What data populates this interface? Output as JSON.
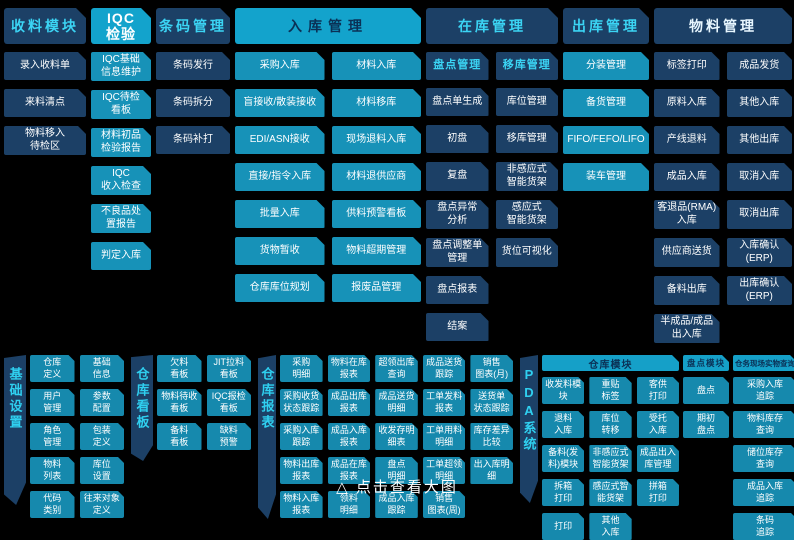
{
  "caption": "△ 点击查看大图",
  "colors": {
    "background": "#000000",
    "navy_block": "#1c4066",
    "teal_block": "#1792b8",
    "bottom_teal_block": "#1689ad",
    "header_cyan": "#13a3cc",
    "cyan_text": "#3bd4f4",
    "white_text": "#ffffff"
  },
  "top": {
    "shouliao": {
      "title": "收料模块",
      "items": [
        "录入收料单",
        "来料清点",
        "物料移入\n待检区"
      ]
    },
    "iqc": {
      "title": "IQC\n检验",
      "items": [
        "IQC基础\n信息维护",
        "IQC待检\n看板",
        "材料初品\n检验报告",
        "IQC\n收入检查",
        "不良品处\n置报告",
        "判定入库"
      ]
    },
    "barcode": {
      "title": "条码管理",
      "items": [
        "条码发行",
        "条码拆分",
        "条码补打"
      ]
    },
    "inbound": {
      "title": "入库管理",
      "col1": [
        "采购入库",
        "盲接收/散装接收",
        "EDI/ASN接收",
        "直接/指令入库",
        "批量入库",
        "货物暂收",
        "仓库库位规划"
      ],
      "col2": [
        "材料入库",
        "材料移库",
        "现场退料入库",
        "材料退供应商",
        "供料预警看板",
        "物料超期管理",
        "报废品管理"
      ]
    },
    "instock": {
      "title": "在库管理",
      "sub1": "盘点管理",
      "sub2": "移库管理",
      "col1": [
        "盘点单生成",
        "初盘",
        "复盘",
        "盘点异常\n分析",
        "盘点调整单\n管理",
        "盘点报表",
        "结案"
      ],
      "col2": [
        "库位管理",
        "移库管理",
        "非感应式\n智能货架",
        "感应式\n智能货架",
        "货位可视化"
      ]
    },
    "outbound": {
      "title": "出库管理",
      "items": [
        "分装管理",
        "备货管理",
        "FIFO/FEFO/LIFO",
        "装车管理"
      ]
    },
    "material": {
      "title": "物料管理",
      "col1": [
        "标签打印",
        "原料入库",
        "产线退料",
        "成品入库",
        "客退品(RMA)\n入库",
        "供应商送货",
        "备料出库",
        "半成品/成品\n出入库"
      ],
      "col2": [
        "成品发货",
        "其他入库",
        "其他出库",
        "取消入库",
        "取消出库",
        "入库确认\n(ERP)",
        "出库确认\n(ERP)"
      ]
    }
  },
  "bottom": {
    "basic": {
      "ribbon": "基础设置",
      "col1": [
        "仓库\n定义",
        "用户\n管理",
        "角色\n管理",
        "物料\n列表",
        "代码\n类别"
      ],
      "col2": [
        "基础\n信息",
        "参数\n配置",
        "包装\n定义",
        "库位\n设置",
        "往来对象\n定义"
      ]
    },
    "kanban": {
      "ribbon": "仓库看板",
      "col1": [
        "欠料\n看板",
        "物料待收\n看板",
        "备料\n看板"
      ],
      "col2": [
        "JIT拉料\n看板",
        "IQC报检\n看板",
        "缺料\n预警"
      ]
    },
    "report": {
      "ribbon": "仓库报表",
      "c1": [
        "采购\n明细",
        "采购收货\n状态跟踪",
        "采购入库\n跟踪",
        "物料出库\n报表",
        "物料入库\n报表"
      ],
      "c2": [
        "物料在库\n报表",
        "成品出库\n报表",
        "成品入库\n报表",
        "成品在库\n报表",
        "领料\n明细"
      ],
      "c3": [
        "超领出库\n查询",
        "成品送货\n明细",
        "收发存明\n细表",
        "盘点\n明细",
        "成品入库\n跟踪"
      ],
      "c4": [
        "成品送货\n跟踪",
        "工单发料\n报表",
        "工单用料\n明细",
        "工单超领\n明细",
        "销售\n图表(周)"
      ],
      "c5": [
        "销售\n图表(月)",
        "送货单\n状态跟踪",
        "库存差异\n比较",
        "出入库明\n细"
      ]
    },
    "pda": {
      "ribbon": "PDA系统",
      "warehouse_header": "仓库模块",
      "count_header": "盘点模块",
      "query_header": "仓务现场实物查询",
      "wc1": [
        "收发料模\n块",
        "退料\n入库",
        "备料(发\n料)模块",
        "拆箱\n打印",
        "打印"
      ],
      "wc2": [
        "重贴\n标签",
        "库位\n转移",
        "非感应式\n智能货架",
        "感应式智\n能货架",
        "其他\n入库"
      ],
      "wc3": [
        "客供\n打印",
        "受托\n入库",
        "成品出入\n库管理",
        "拼箱\n打印"
      ],
      "count_items": [
        "盘点",
        "期初\n盘点"
      ],
      "query_items": [
        "采购入库\n追踪",
        "物料库存\n查询",
        "储位库存\n查询",
        "成品入库\n追踪",
        "条码\n追踪"
      ]
    }
  }
}
